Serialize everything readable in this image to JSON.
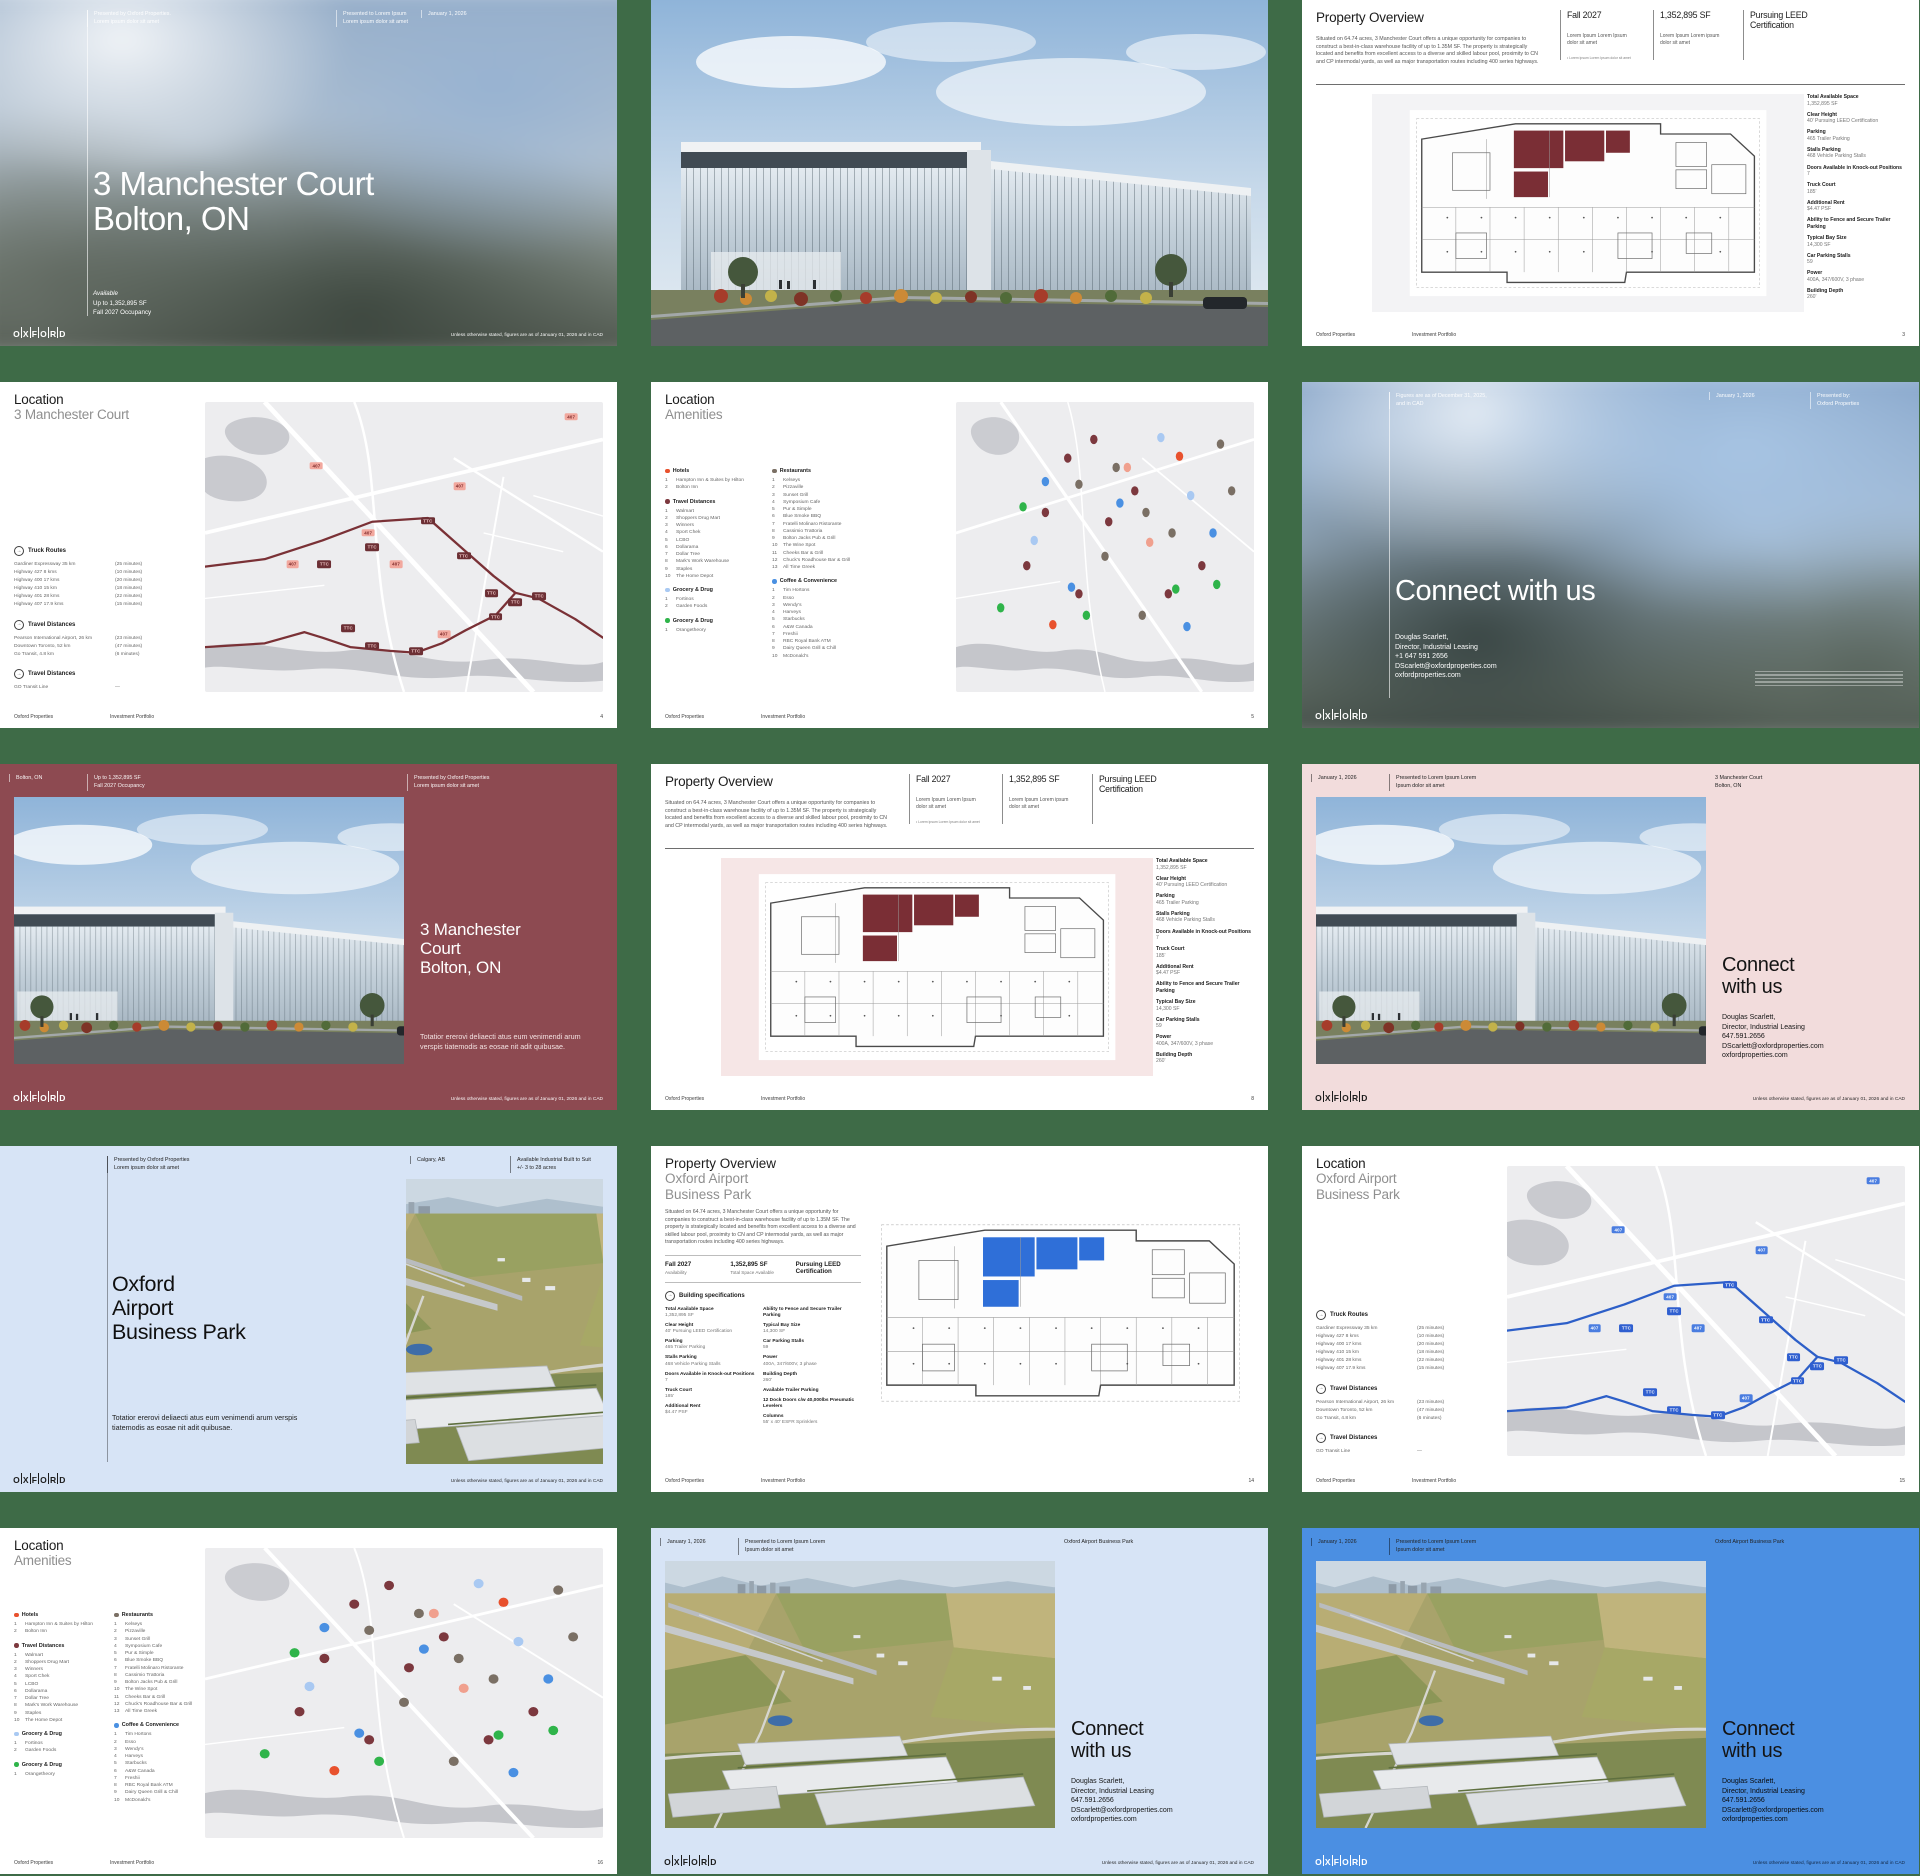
{
  "brand": {
    "name": "OXFORD"
  },
  "common": {
    "company": "Oxford Properties",
    "portfolio": "Investment Portfolio",
    "disclaimer": "Unless otherwise stated, figures are as of January 01, 2026 and in CAD"
  },
  "maps": {
    "highway_badge": "407",
    "transit_badge": "TTC"
  },
  "cover": {
    "presented_by": "Presented by Oxford Properties.",
    "presented_by_sub": "Lorem ipsum dolor sit amet",
    "presented_to": "Presented to Lorem Ipsum",
    "presented_to_sub": "Lorem ipsum dolor sit amet",
    "date": "January 1, 2026",
    "title1": "3 Manchester Court",
    "title2": "Bolton, ON",
    "avail_label": "Available",
    "avail_sf": "Up to 1,352,895 SF",
    "avail_occ": "Fall 2027 Occupancy"
  },
  "overview": {
    "title": "Property Overview",
    "body": "Situated on 64.74 acres, 3 Manchester Court offers a unique opportunity for companies to construct a best-in-class warehouse facility of up to 1.35M SF. The property is strategically located and benefits from excellent access to a diverse and skilled labour pool, proximity to CN and CP intermodal yards, as well as major transportation routes including 400 series highways.",
    "stats": [
      {
        "value": "Fall 2027",
        "caption": "Lorem Ipsum Lorem Ipsum dolor sit amet",
        "note": "• Lorem ipsum Lorem Ipsum dolor sit amet"
      },
      {
        "value": "1,352,895 SF",
        "caption": "Lorem Ipsum Lorem ipsum dolor sit amet"
      },
      {
        "value": "Pursuing LEED Certification"
      }
    ],
    "sidebar_specs": [
      {
        "label": "Total Available Space",
        "value": "1,352,895 SF"
      },
      {
        "label": "Clear Height",
        "value": "40' Pursuing LEED Certification"
      },
      {
        "label": "Parking",
        "value": "465 Trailer Parking"
      },
      {
        "label": "Stalls Parking",
        "value": "468 Vehicle Parking Stalls"
      },
      {
        "label": "Doors Available in Knock-out Positions",
        "value": "7"
      },
      {
        "label": "Truck Court",
        "value": "185'"
      },
      {
        "label": "Additional Rent",
        "value": "$4.47 PSF"
      },
      {
        "label": "Ability to Fence and Secure Trailer Parking",
        "value": ""
      },
      {
        "label": "Typical Bay Size",
        "value": "14,300 SF"
      },
      {
        "label": "Car Parking Stalls",
        "value": "59"
      },
      {
        "label": "Power",
        "value": "400A, 347/600V, 3 phase"
      },
      {
        "label": "Building Depth",
        "value": "260'"
      }
    ],
    "page3": "3",
    "page8": "8"
  },
  "bpark": {
    "title": "Property Overview",
    "subtitle1": "Oxford Airport",
    "subtitle2": "Business Park",
    "body": "Situated on 64.74 acres, 3 Manchester Court offers a unique opportunity for companies to construct a best-in-class warehouse facility of up to 1.35M SF. The property is strategically located and benefits from excellent access to a diverse and skilled labour pool, proximity to CN and CP intermodal yards, as well as major transportation routes including 400 series highways.",
    "stats": [
      {
        "value": "Fall 2027",
        "caption": "Availability"
      },
      {
        "value": "1,352,895 SF",
        "caption": "Total Space Available"
      },
      {
        "value": "Pursuing LEED Certification",
        "caption": ""
      }
    ],
    "specs_heading": "Building specifications",
    "col1": [
      {
        "label": "Total Available Space",
        "value": "1,352,895 SF"
      },
      {
        "label": "Clear Height",
        "value": "40' Pursuing LEED Certification"
      },
      {
        "label": "Parking",
        "value": "465 Trailer Parking"
      },
      {
        "label": "Stalls Parking",
        "value": "468 Vehicle Parking Stalls"
      },
      {
        "label": "Doors Available in Knock-out Positions",
        "value": "7"
      },
      {
        "label": "Truck Court",
        "value": "185'"
      },
      {
        "label": "Additional Rent",
        "value": "$4.47 PSF"
      }
    ],
    "col2": [
      {
        "label": "Ability to Fence and Secure Trailer Parking",
        "value": ""
      },
      {
        "label": "Typical Bay Size",
        "value": "14,300 SF"
      },
      {
        "label": "Car Parking Stalls",
        "value": "59"
      },
      {
        "label": "Power",
        "value": "400A, 347/600V, 3 phase"
      },
      {
        "label": "Building Depth",
        "value": "260'"
      },
      {
        "label": "Available Trailer Parking",
        "value": ""
      },
      {
        "label": "12 Dock Doors c/w 40,000lbs Pneumatic Levelers",
        "value": ""
      },
      {
        "label": "Columns",
        "value": "55' x 40' ESFR Sprinklers"
      }
    ],
    "page": "14"
  },
  "location": {
    "title": "Location",
    "subtitle_mc": "3 Manchester Court",
    "subtitle_ab1": "Oxford Airport",
    "subtitle_ab2": "Business Park",
    "truck_routes": {
      "label": "Truck Routes",
      "rows": [
        {
          "n": "Gardiner Expressway 35 km",
          "t": "(25 minutes)"
        },
        {
          "n": "Highway 427 8 kms",
          "t": "(10 minutes)"
        },
        {
          "n": "Highway 400 17 kms",
          "t": "(20 minutes)"
        },
        {
          "n": "Highway 410 15 km",
          "t": "(18 minutes)"
        },
        {
          "n": "Highway 401 28 kms",
          "t": "(22 minutes)"
        },
        {
          "n": "Highway 407 17.9 kms",
          "t": "(15 minutes)"
        }
      ]
    },
    "travel": {
      "label": "Travel Distances",
      "rows": [
        {
          "n": "Pearson International Airport, 26 km",
          "t": "(23 minutes)"
        },
        {
          "n": "Downtown Toronto, 52 km",
          "t": "(47 minutes)"
        },
        {
          "n": "Go Transit, 4.8 km",
          "t": "(6 minutes)"
        }
      ]
    },
    "transit": {
      "label": "Travel Distances",
      "rows": [
        {
          "n": "GO Transit Line",
          "t": "—"
        }
      ]
    },
    "page4": "4",
    "page15": "15"
  },
  "amenities": {
    "title1": "Location",
    "title2": "Amenities",
    "colA": [
      {
        "name": "Hotels",
        "color": "#e8512d",
        "items": [
          "Hampton Inn & Suites by Hilton",
          "Bolton Inn"
        ]
      },
      {
        "name": "Travel Distances",
        "color": "#7c383e",
        "items": [
          "Walmart",
          "Shoppers Drug Mart",
          "Winners",
          "Sport Chek",
          "LCBO",
          "Dollarama",
          "Dollar Tree",
          "Mark's Work Warehouse",
          "Staples",
          "The Home Depot"
        ]
      },
      {
        "name": "Grocery & Drug",
        "color": "#a9c9f2",
        "items": [
          "Fortinos",
          "Garden Foods"
        ]
      },
      {
        "name": "Grocery & Drug",
        "color": "#2fb44a",
        "items": [
          "Orangetheory"
        ]
      }
    ],
    "colB": [
      {
        "name": "Restaurants",
        "color": "#7a6f64",
        "items": [
          "Kelseys",
          "Pizzaville",
          "Sunset Grill",
          "Symposium Cafe",
          "Pur & Simple",
          "Blue Smoke BBQ",
          "Fratelli Molinaro Ristorante",
          "Cassimio Trattoria",
          "Bolton Jacks Pub & Grill",
          "The Wine Spot",
          "Cheeks Bar & Grill",
          "Chuck's Roadhouse Bar & Grill",
          "All Time Greek"
        ]
      },
      {
        "name": "Coffee & Convenience",
        "color": "#4a90e2",
        "items": [
          "Tim Hortons",
          "Esso",
          "Wendy's",
          "Harveys",
          "Starbucks",
          "A&W Canada",
          "Freshii",
          "RBC Royal Bank ATM",
          "Dairy Queen Grill & Chill",
          "McDonald's"
        ]
      }
    ],
    "page5": "5",
    "page16": "16"
  },
  "connect": {
    "heading_inline": "Connect with us",
    "heading1": "Connect",
    "heading2": "with us",
    "name": "Douglas Scarlett,",
    "role": "Director, Industrial Leasing",
    "phone_intl": "+1 647 591 2656",
    "phone_dot": "647.591.2656",
    "email": "DScarlett@oxfordproperties.com",
    "web": "oxfordproperties.com",
    "s6": {
      "figures1": "Figures are as of December 31, 2025,",
      "figures2": "and in CAD",
      "date": "January 1, 2026",
      "by1": "Presented by:",
      "by2": "Oxford Properties"
    },
    "s9": {
      "date": "January 1, 2026",
      "to1": "Presented to Lorem Ipsum Lorem",
      "to2": "Ipsum dolor sit amet",
      "prop1": "3 Manchester Court",
      "prop2": "Bolton, ON"
    },
    "s14": {
      "date": "January 1, 2026",
      "to1": "Presented to Lorem Ipsum Lorem",
      "to2": "Ipsum dolor sit amet",
      "prop": "Oxford Airport Business Park"
    }
  },
  "red7": {
    "loc": "Bolton, ON",
    "sf": "Up to 1,352,895 SF",
    "occ": "Fall 2027 Occupancy",
    "by1": "Presented by Oxford Properties",
    "by2": "Lorem ipsum dolor sit amet",
    "title1": "3 Manchester",
    "title2": "Court",
    "title3": "Bolton, ON",
    "body": "Totatior ererovi deliaecti atus eum venimendi arum verspis tiatemodis as eosae nit adit quibusae."
  },
  "blue10": {
    "by1": "Presented by Oxford Properties",
    "by2": "Lorem ipsum dolor sit amet",
    "city": "Calgary, AB",
    "avail1": "Available Industrial Built to Suit",
    "avail2": "+/- 3 to 28 acres",
    "title1": "Oxford",
    "title2": "Airport",
    "title3": "Business Park",
    "body": "Totatior ererovi deliaecti atus eum venimendi arum verspis tiatemodis as eosae nit adit quibusae."
  }
}
